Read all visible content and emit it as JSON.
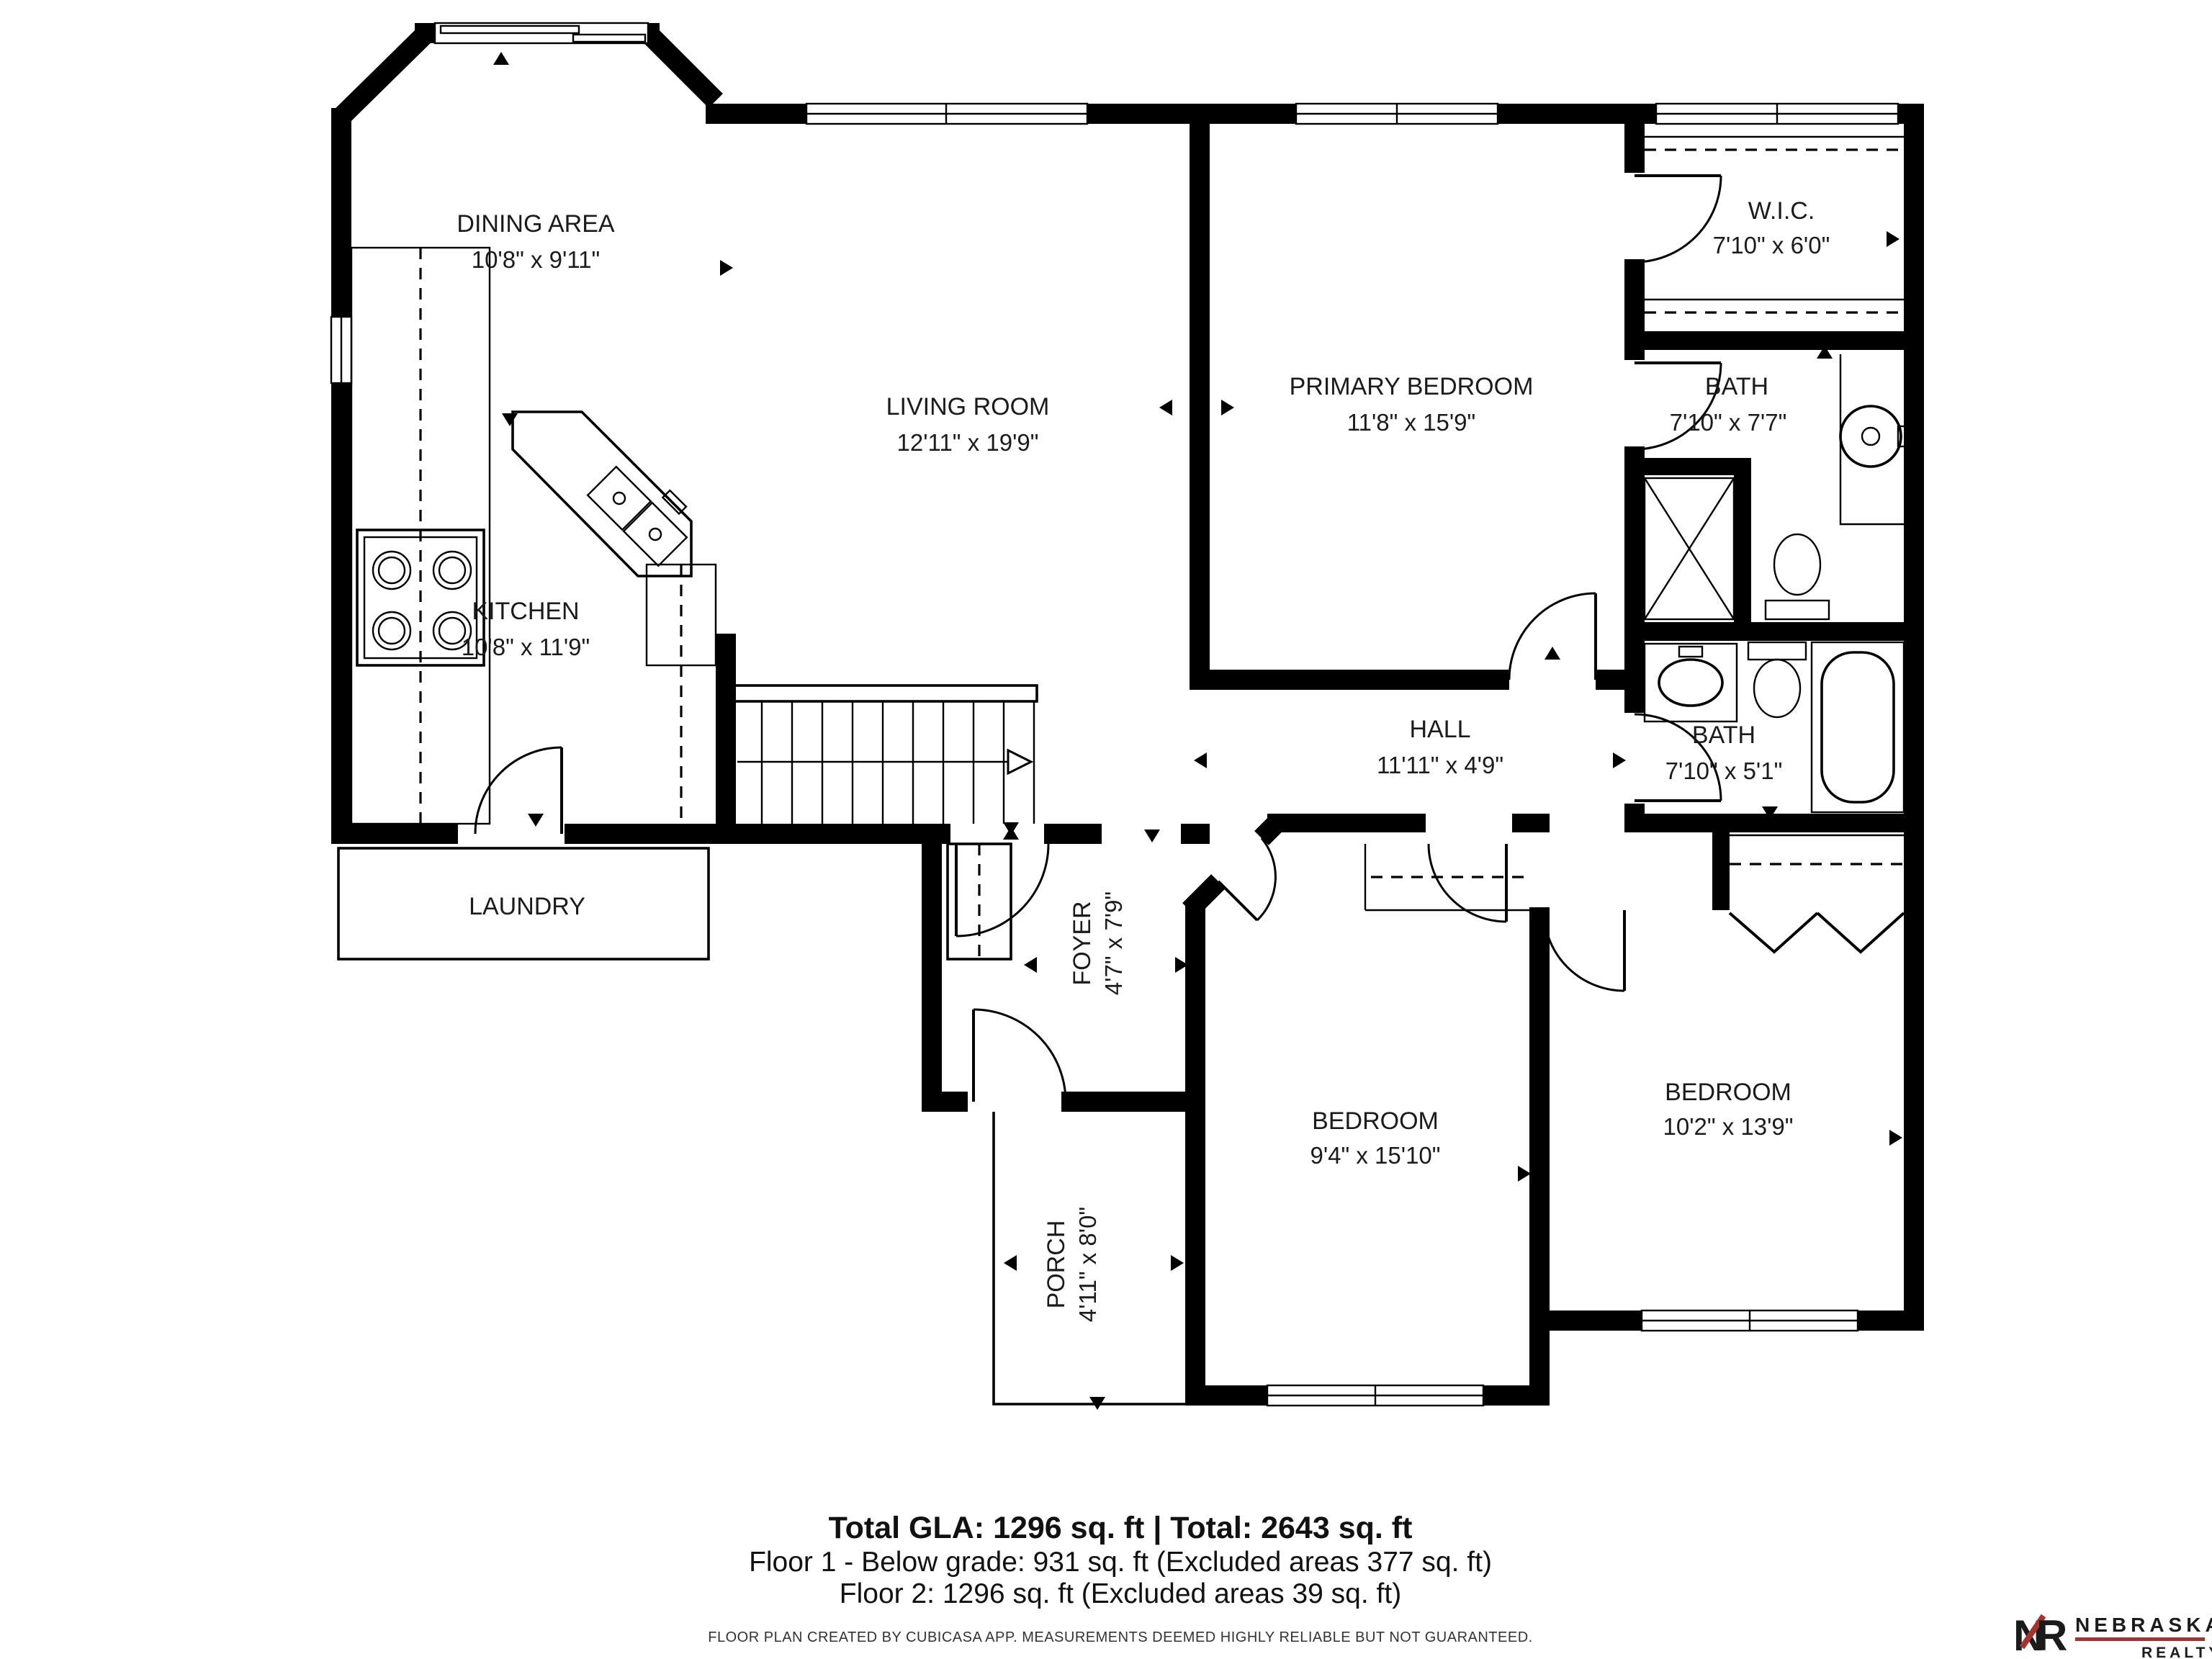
{
  "rooms": [
    {
      "name": "DINING AREA",
      "dims": "10'8\" x 9'11\""
    },
    {
      "name": "LIVING ROOM",
      "dims": "12'11\" x 19'9\""
    },
    {
      "name": "PRIMARY BEDROOM",
      "dims": "11'8\" x 15'9\""
    },
    {
      "name": "W.I.C.",
      "dims": "7'10\" x 6'0\""
    },
    {
      "name": "BATH",
      "dims": "7'10\" x 7'7\""
    },
    {
      "name": "KITCHEN",
      "dims": "10'8\" x 11'9\""
    },
    {
      "name": "HALL",
      "dims": "11'11\" x 4'9\""
    },
    {
      "name": "BATH",
      "dims": "7'10\" x 5'1\""
    },
    {
      "name": "LAUNDRY",
      "dims": ""
    },
    {
      "name": "FOYER",
      "dims": "4'7\" x 7'9\""
    },
    {
      "name": "BEDROOM",
      "dims": "9'4\" x 15'10\""
    },
    {
      "name": "BEDROOM",
      "dims": "10'2\" x 13'9\""
    },
    {
      "name": "PORCH",
      "dims": "4'11\" x 8'0\""
    }
  ],
  "summary": {
    "line1": "Total GLA: 1296 sq. ft | Total: 2643 sq. ft",
    "line2": "Floor 1 - Below grade: 931 sq. ft (Excluded areas 377 sq. ft)",
    "line3": "Floor 2: 1296 sq. ft (Excluded areas 39 sq. ft)"
  },
  "disclaimer": "FLOOR PLAN CREATED BY CUBICASA APP. MEASUREMENTS DEEMED HIGHLY RELIABLE BUT NOT GUARANTEED.",
  "brand": {
    "monogram_n": "N",
    "monogram_r": "R",
    "name": "NEBRASKA",
    "subname": "REALTY",
    "dark": "#3f3e40",
    "red": "#a3342f"
  },
  "colors": {
    "wall": "#000000",
    "background": "#ffffff",
    "text": "#1b1b1b"
  }
}
